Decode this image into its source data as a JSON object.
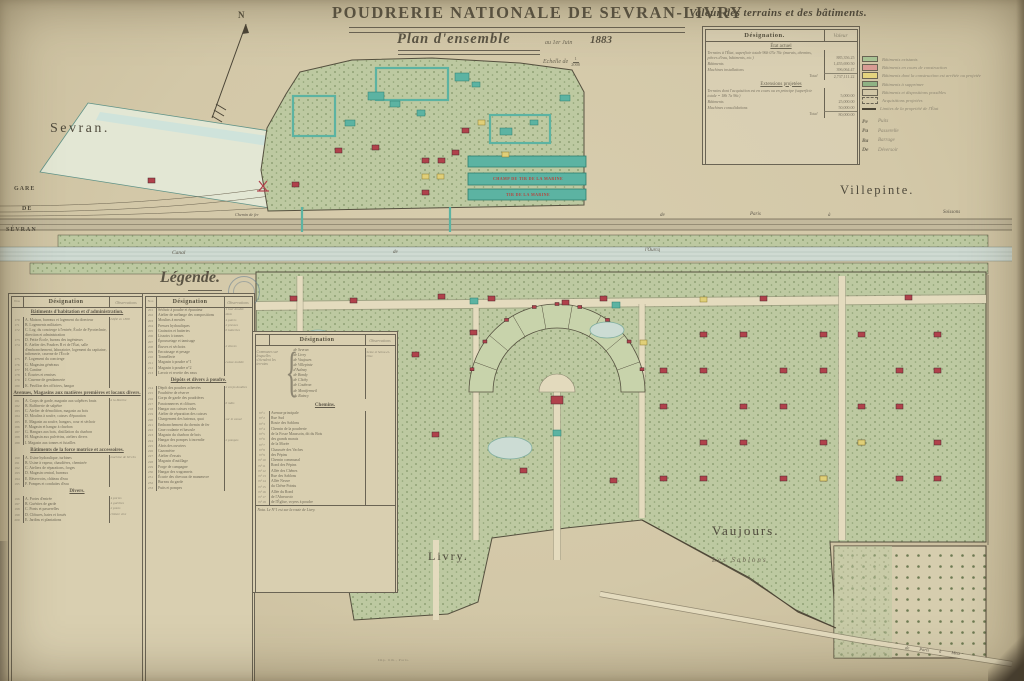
{
  "title": {
    "main": "POUDRERIE NATIONALE DE SEVRAN-LIVRY",
    "plan": "Plan d'ensemble",
    "date_prefix": "au 1er Juin",
    "year": "1883",
    "scale_label": "Echelle de",
    "scale_num": "1",
    "scale_den": "2000"
  },
  "compass": {
    "label": "N"
  },
  "valeur_table": {
    "heading": "Valeur des terrains et des bâtiments.",
    "col_designation": "Désignation.",
    "col_valeur": "Valeur",
    "sections": [
      {
        "header": "État actuel",
        "rows": [
          {
            "label": "Terrains à l'État, superficie totale 96h 07a 76c (marais, chemins, pièces d'eau, bâtiments, etc.)",
            "value": "885,356.25"
          },
          {
            "label": "Bâtiments",
            "value": "1,455,690.50"
          },
          {
            "label": "Machines installations",
            "value": "396,064.47"
          }
        ],
        "total_label": "Total",
        "total_value": "2,737,111.22"
      },
      {
        "header": "Extensions projetées",
        "rows": [
          {
            "label": "Terrains dont l'acquisition est en cours ou en principe (superficie totale = 18h 7a 96c)",
            "value": "5,000.00"
          },
          {
            "label": "Bâtiments",
            "value": "25,000.00"
          },
          {
            "label": "Machines consolidations",
            "value": "50,000.00"
          }
        ],
        "total_label": "Total",
        "total_value": "80,000.00"
      }
    ]
  },
  "color_legend": {
    "items": [
      {
        "style": "solid",
        "color": "#a8c394",
        "label": "Bâtiments existants"
      },
      {
        "style": "solid",
        "color": "#d89b93",
        "label": "Bâtiments en cours de construction"
      },
      {
        "style": "solid",
        "color": "#e4d47e",
        "label": "Bâtiments dont la construction est arrêtée ou projetée"
      },
      {
        "style": "solid",
        "color": "#8fb284",
        "label": "Bâtiments à supprimer"
      },
      {
        "style": "outline",
        "color": "",
        "label": "Bâtiments et dispositions possibles"
      },
      {
        "style": "dashed",
        "color": "",
        "label": "Acquisitions projetées"
      },
      {
        "style": "line",
        "color": "#4a4436",
        "label": "Limites de la propriété de l'État"
      }
    ],
    "abbrevs": [
      {
        "code": "Pe",
        "label": "Puits"
      },
      {
        "code": "Pa",
        "label": "Passerelle"
      },
      {
        "code": "Ba",
        "label": "Barrage"
      },
      {
        "code": "De",
        "label": "Déversoir"
      }
    ]
  },
  "map_labels": {
    "sevran": "Sevran.",
    "villepinte": "Villepinte.",
    "livry": "Livry.",
    "vaujours": "Vaujours.",
    "les_sablons": "Les Sablons",
    "gare1": "GARE",
    "gare2": "DE",
    "gare3": "SÉVRAN",
    "rail0": "Chemin de fer",
    "rail1": "de",
    "rail2": "Paris",
    "rail3": "à",
    "rail4": "Soissons",
    "canal1": "Canal",
    "canal2": "de",
    "canal3": "l'Ourcq",
    "champ_tir_1": "CHAMP DE TIR DE LA MARINE",
    "champ_tir_2": "TIR DE LA MARINE",
    "road_metz": "de Paris à Metz"
  },
  "legende": {
    "title": "Légende.",
    "cols": {
      "no": "Nos",
      "designation": "Désignation",
      "observations": "Observations"
    },
    "table1": {
      "sections": [
        {
          "header": "Bâtiments d'habitation et d'administration.",
          "rows": [
            [
              "170",
              "A. Maison, bureaux et logement du directeur",
              "édifié en 1868"
            ],
            [
              "171",
              "B. Logements militaires",
              ""
            ],
            [
              "172",
              "C. Log. du concierge à l'entrée, École de Pyrotechnie, direction et administration",
              ""
            ],
            [
              "173",
              "D. Petite École, bureau des ingénieurs",
              ""
            ],
            [
              "174",
              "E. Atelier des Poudres B et de l'État, salle d'embranchement, laboratoire, logement du capitaine, infirmerie, caserne de l'École",
              ""
            ],
            [
              "175",
              "F. Logement du concierge",
              ""
            ],
            [
              "176",
              "G. Magasins généraux",
              ""
            ],
            [
              "177",
              "H. Cantine",
              ""
            ],
            [
              "178",
              "I. Écuries et remises",
              ""
            ],
            [
              "179",
              "J. Caserne de gendarmerie",
              ""
            ],
            [
              "180",
              "K. Pavillon des officiers, hangar",
              ""
            ]
          ]
        },
        {
          "header": "Avenues, Magasins aux matières premières et locaux divers.",
          "rows": [
            [
              "181",
              "A. Corps de garde, magasin aux salpêtres bruts",
              "à la Marine"
            ],
            [
              "182",
              "B. Raffinerie de salpêtre",
              ""
            ],
            [
              "183",
              "C. Atelier de démolition, magasin au bois",
              ""
            ],
            [
              "184",
              "D. Moulins à soufre, caisses d'épuration",
              ""
            ],
            [
              "185",
              "E. Magasin au soufre, hangars, cour et séchoir",
              ""
            ],
            [
              "186",
              "F. Magasin et hangar à charbon",
              ""
            ],
            [
              "187",
              "G. Hangars aux bois, distillation du charbon",
              ""
            ],
            [
              "188",
              "H. Magasin aux pulvérins, ateliers divers",
              ""
            ],
            [
              "189",
              "I. Magasin aux tonnes et futailles",
              ""
            ]
          ]
        },
        {
          "header": "Bâtiments de la force motrice et accessoires.",
          "rows": [
            [
              "190",
              "A. Usine hydraulique, turbines",
              "machine de 60 chx"
            ],
            [
              "191",
              "B. Usine à vapeur, chaudières, cheminée",
              ""
            ],
            [
              "192",
              "C. Ateliers de réparations, forges",
              ""
            ],
            [
              "193",
              "D. Magasin central, bureaux",
              ""
            ],
            [
              "194",
              "E. Réservoirs, château d'eau",
              ""
            ],
            [
              "195",
              "F. Pompes et conduites d'eau",
              ""
            ]
          ]
        },
        {
          "header": "Divers.",
          "rows": [
            [
              "196",
              "A. Portes d'entrée",
              "4 portes"
            ],
            [
              "197",
              "B. Guérites de garde",
              "4 guérites"
            ],
            [
              "198",
              "C. Ponts et passerelles",
              "2 ponts"
            ],
            [
              "199",
              "D. Clôtures, haies et fossés",
              "clôture vive"
            ],
            [
              "200",
              "E. Jardins et plantations",
              ""
            ]
          ]
        }
      ]
    },
    "table2": {
      "sections": [
        {
          "header": null,
          "rows": [
            [
              "201",
              "Séchoir à poudre et épurateur",
              "1 tour double"
            ],
            [
              "202",
              "Atelier de mélange des compositions",
              "idem"
            ],
            [
              "203",
              "Moulins à meules",
              "4 paires"
            ],
            [
              "204",
              "Presses hydrauliques",
              "2 presses"
            ],
            [
              "205",
              "Grainoirs et batteries",
              "6 batteries"
            ],
            [
              "206",
              "Lissoirs à tonnes",
              ""
            ],
            [
              "207",
              "Époussetage et tamisage",
              ""
            ],
            [
              "208",
              "Étuves et séchoirs",
              "2 étuves"
            ],
            [
              "209",
              "Encaissage et pesage",
              ""
            ],
            [
              "210",
              "Tonnellerie",
              ""
            ],
            [
              "211",
              "Magasin à poudre n°1",
              "caisse mobile"
            ],
            [
              "212",
              "Magasin à poudre n°2",
              ""
            ],
            [
              "213",
              "Lavoir et recette des eaux",
              ""
            ]
          ]
        },
        {
          "header": "Dépôts et divers à poudre.",
          "rows": [
            [
              "214",
              "Dépôt des poudres achevées",
              "2 corps doubles"
            ],
            [
              "215",
              "Poudrière de réserve",
              ""
            ],
            [
              "216",
              "Corps de garde des poudrières",
              ""
            ],
            [
              "217",
              "Paratonnerres et clôtures",
              "6 mâts"
            ],
            [
              "218",
              "Hangar aux caisses vides",
              ""
            ],
            [
              "219",
              "Atelier de réparation des caisses",
              ""
            ],
            [
              "220",
              "Chargement des bateaux, quai",
              "sur le canal"
            ],
            [
              "221",
              "Embranchement du chemin de fer",
              ""
            ],
            [
              "222",
              "Grue roulante et bascule",
              ""
            ],
            [
              "223",
              "Magasin du charbon de bois",
              ""
            ],
            [
              "224",
              "Hangar des pompes à incendie",
              "2 pompes"
            ],
            [
              "225",
              "Abris des ouvriers",
              ""
            ],
            [
              "226",
              "Gazomètre",
              ""
            ],
            [
              "227",
              "Atelier d'essais",
              ""
            ],
            [
              "228",
              "Magasin d'outillage",
              ""
            ],
            [
              "229",
              "Forge de campagne",
              ""
            ],
            [
              "230",
              "Hangar des wagonnets",
              ""
            ],
            [
              "231",
              "Écurie des chevaux de manœuvre",
              ""
            ],
            [
              "232",
              "Bureau du garde",
              ""
            ],
            [
              "233",
              "Puits et pompes",
              ""
            ]
          ]
        }
      ]
    },
    "table3": {
      "designation": "Désignation",
      "observations": "Observations",
      "communes_label": "Communes sur lesquelles s'étendent les terrains",
      "communes": [
        "de Sevran",
        "de Livry",
        "de Vaujours",
        "de Villepinte",
        "d'Aulnay",
        "de Bondy",
        "de Clichy",
        "de Coubron",
        "de Montfermeil",
        "du Raincy"
      ],
      "communes_obs": "Seine et Seine-et-Oise",
      "chemins_header": "Chemins.",
      "chemins": [
        [
          "N°1",
          "Avenue principale"
        ],
        [
          "N°2",
          "Rue Sud"
        ],
        [
          "N°3",
          "Route des Sablons"
        ],
        [
          "N°4",
          "Chemin de la poudrerie"
        ],
        [
          "N°5",
          "de la Fosse Maussoin, dit du Bois"
        ],
        [
          "N°6",
          "des grands marais"
        ],
        [
          "N°7",
          "de la Morée"
        ],
        [
          "N°8",
          "Chaussée des Vaches"
        ],
        [
          "N°9",
          "des Pépins"
        ],
        [
          "N°10",
          "Chemin communal"
        ],
        [
          "N°11",
          "Rond des Pépins"
        ],
        [
          "N°12",
          "Allée des Chênes"
        ],
        [
          "N°13",
          "Rue des Sablons"
        ],
        [
          "N°14",
          "Allée Neuve"
        ],
        [
          "N°15",
          "du Chêne Pointu"
        ],
        [
          "N°16",
          "Allée du Rond"
        ],
        [
          "N°17",
          "de l'Abreuvoir"
        ],
        [
          "N°18",
          "de l'Église, voyers à poudre"
        ]
      ],
      "note": "Nota. Le N°1 est sur la route de Livry."
    }
  },
  "imprint": "Imp. lith., Paris.",
  "colors": {
    "paper": "#d5caab",
    "ink": "#55503f",
    "map_green": "#bdc9a1",
    "teal": "#5cb3a2",
    "red": "#b0414b",
    "yellow": "#e0cf78",
    "water": "#cfdad2",
    "label_red": "#b5453f"
  }
}
